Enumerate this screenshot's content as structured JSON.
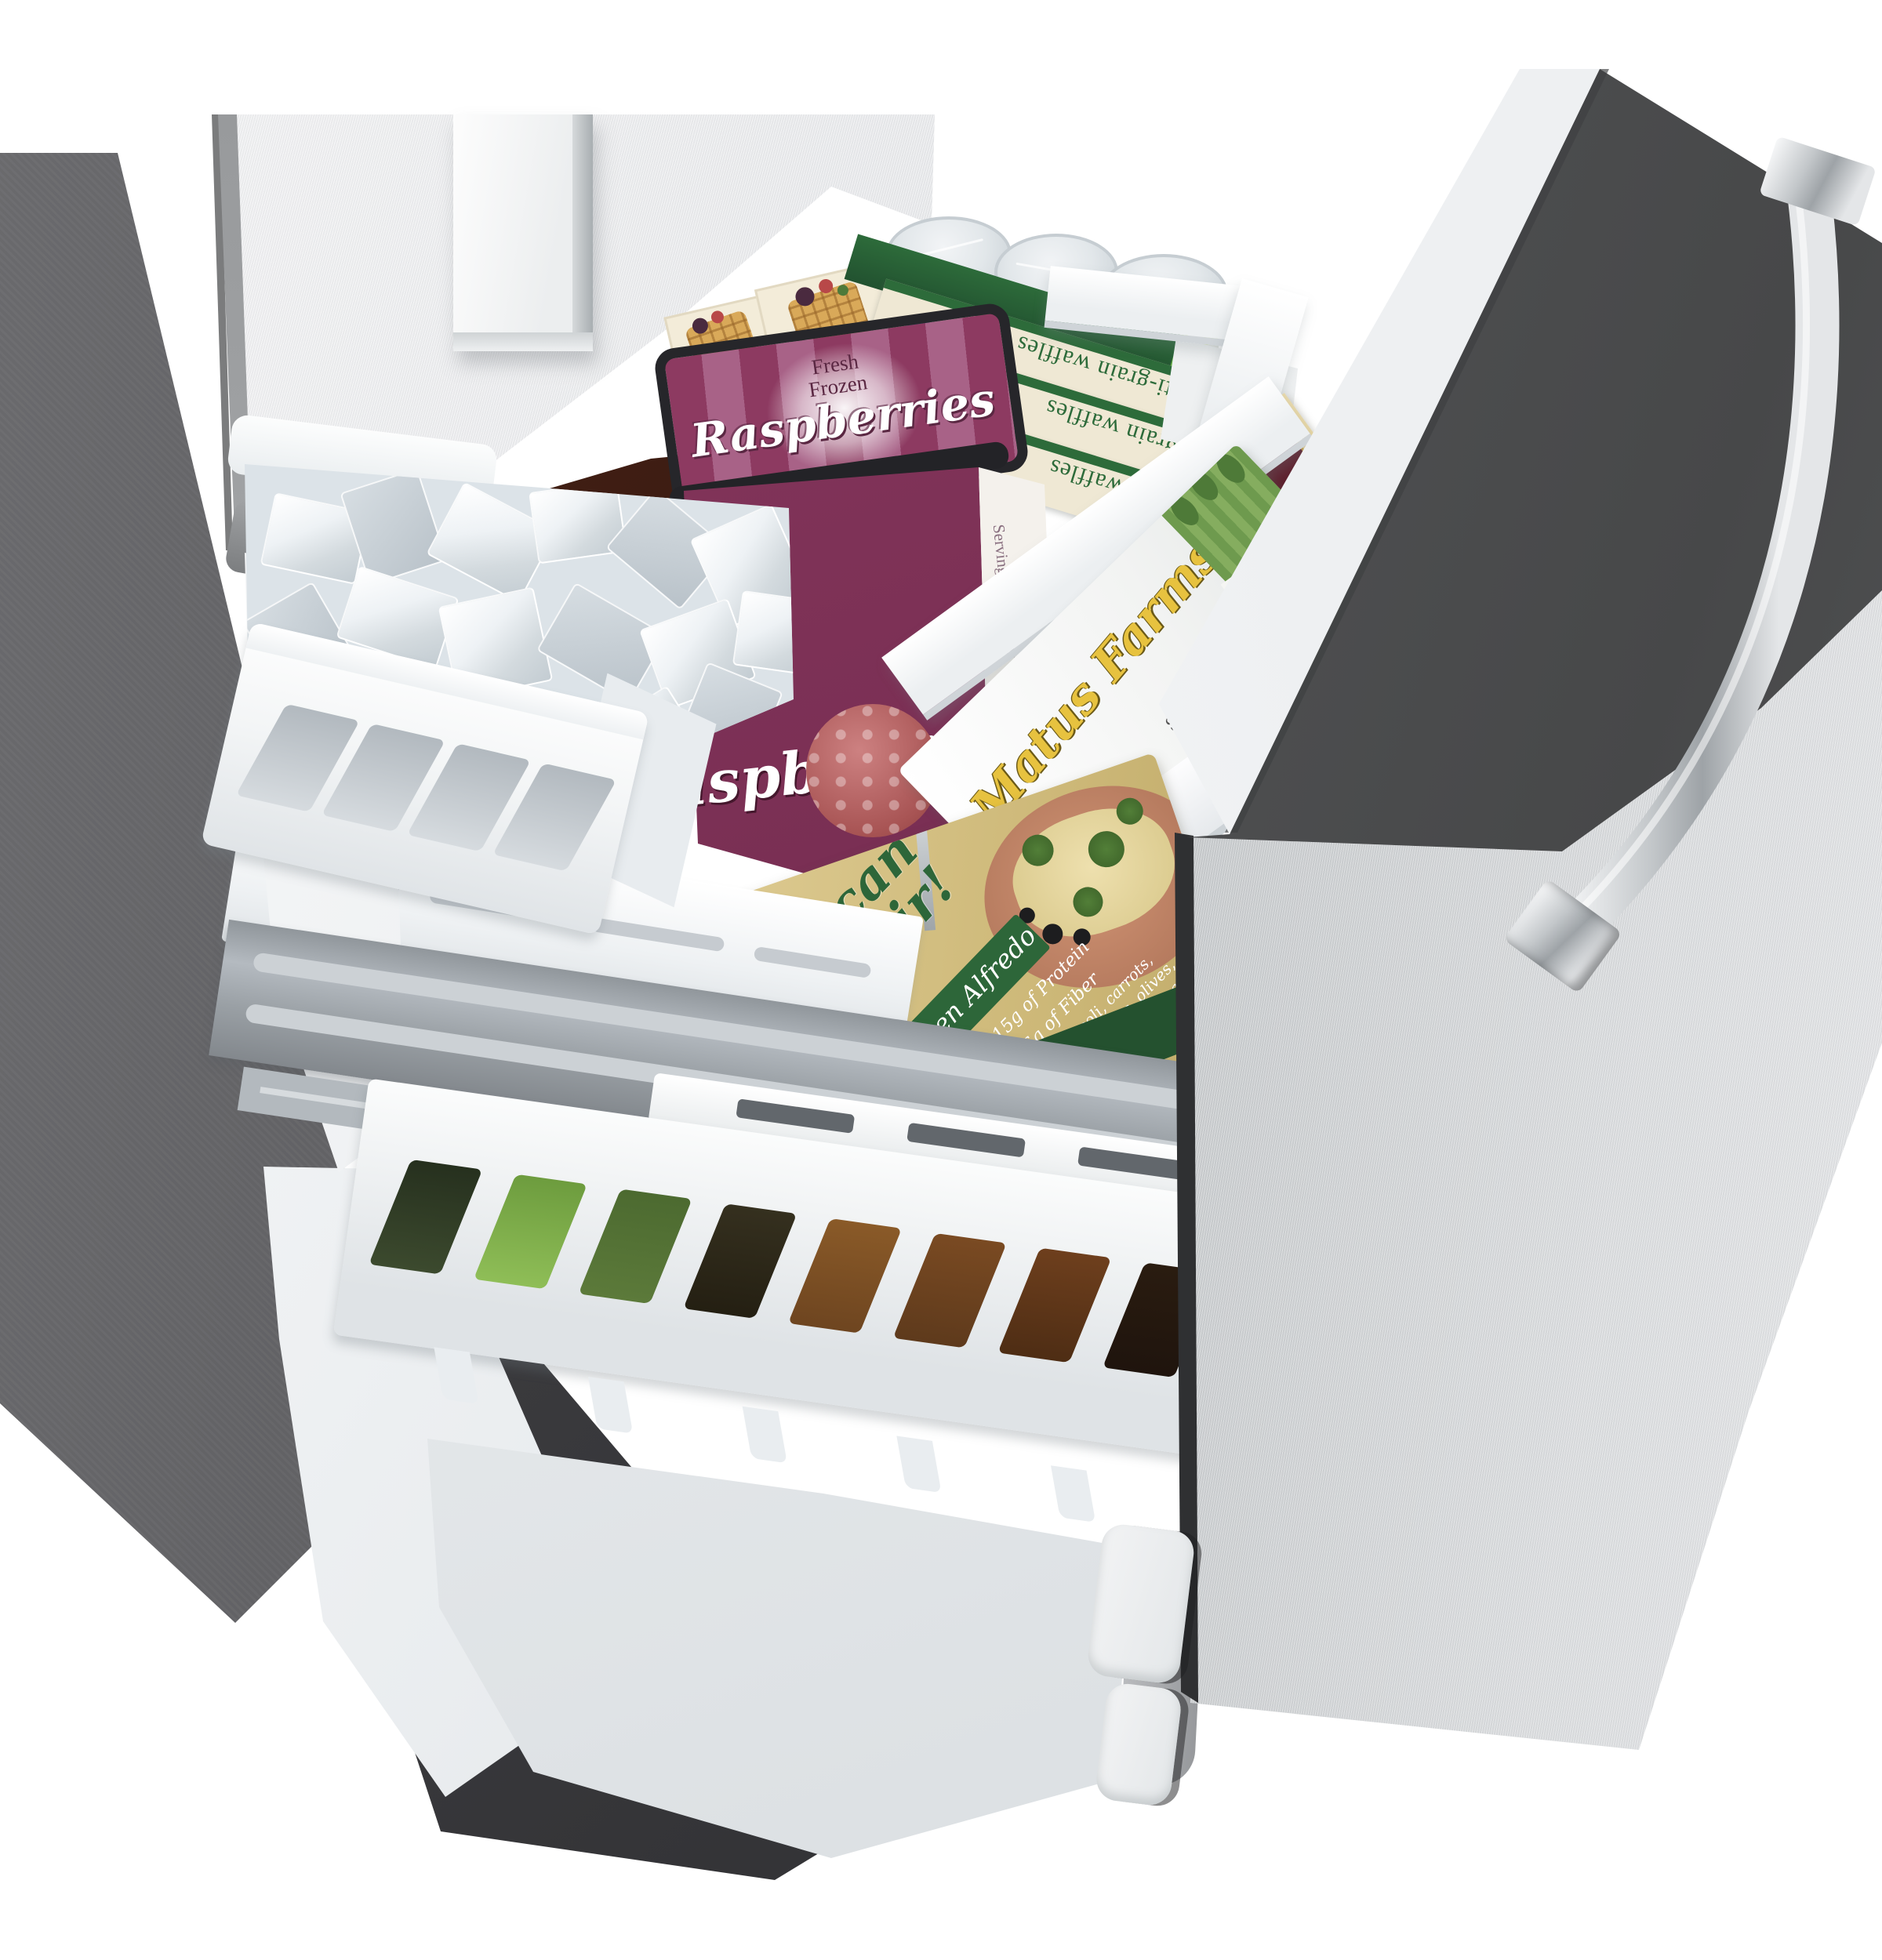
{
  "photo": {
    "subject": "refrigerator bottom-freezer drawer pulled open with frozen foods",
    "colors": {
      "stainless": "#d8dadc",
      "cabinet_gray": "#565659",
      "liner_dark": "#515254",
      "chrome": "#c3c7ca",
      "basket_white": "#f4f6f7",
      "tin_purple": "#8d3a61",
      "waffle_green": "#2d6b3a",
      "canister_green": "#63ad42",
      "tuscan_tan": "#cdb878",
      "focaccia_brown": "#3a1d12"
    }
  },
  "packages": {
    "raspberry_tin": {
      "brand_line1": "Fresh",
      "brand_line2": "Frozen",
      "name": "Raspberries",
      "side_heading": "Serving Suggestions"
    },
    "waffles": {
      "name": "multi-grain waffles",
      "badge": "USDA ORGANIC"
    },
    "canister": {
      "label": "E-L"
    },
    "matus": {
      "brand": "Matus Farms",
      "since": "Since 1968",
      "claim1": "Good source of the antioxidant Vitamin C",
      "claim2": "No artificial colors"
    },
    "pepe": {
      "brand": "Pepe G",
      "title": "Fabulous Italian Dishes",
      "subtitle": "Crab Crostini"
    },
    "tuscan": {
      "brand_line1": "Tuscan",
      "brand_line2": "Flair!",
      "variety": "Chicken Alfredo",
      "protein": "15g of Protein",
      "fiber": "6g of Fiber",
      "desc_l1": "broccoli, carrots,",
      "desc_l2": "cucumbers, olives,",
      "desc_l3": "chicken in a creamy",
      "desc_l4": "alfredo sauce",
      "freezer_note": "KEEP FROZEN AND COOK",
      "side_script": "Focaccia"
    },
    "focaccia_bag": {
      "name": "Focaccia"
    }
  }
}
